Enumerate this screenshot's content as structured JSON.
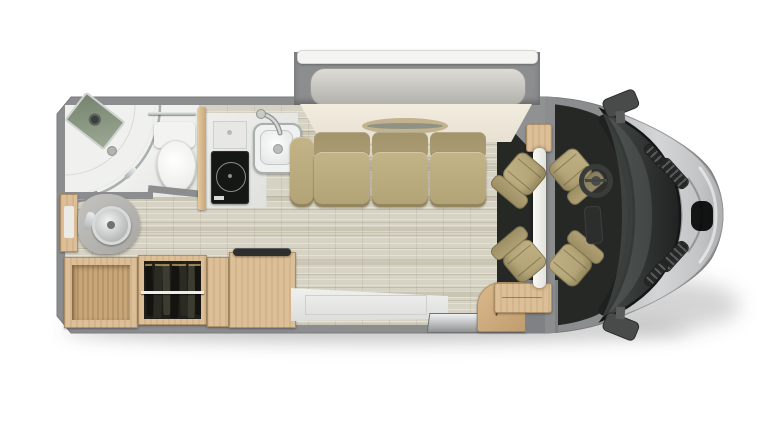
{
  "meta": {
    "view": "top-down RV motorhome floor plan rendering",
    "visible_text": "none"
  },
  "colors": {
    "background": "#ffffff",
    "body_wall_gray": "#8c8d8e",
    "floor_vinyl": "#d7d3c4",
    "bathroom_floor": "#f0f0ee",
    "sofa_tan": "#b9aa7c",
    "cab_seat_tan": "#b3a376",
    "wood_cabinet": "#dcbf96",
    "wood_interior": "#c8a678",
    "cab_floor_dark": "#272927",
    "hood_silver": "#c7c9cb",
    "windshield_dark": "#2e3231",
    "cooktop_black": "#151715",
    "hanging_clothes": "#1f1f1b",
    "chrome_fixture": "#c6cac9",
    "murphy_bed_roll": "#d2d0cb",
    "platform_ivory": "#efe9dc",
    "awning_white": "#f4f4f3"
  },
  "labels": {
    "vehicle": "motorhome floor plan",
    "slide_out": "slide-out room with awning",
    "murphy_bed": "rolled murphy bed",
    "platform": "bed platform with oval inlay",
    "sofa": "three-seat sofa",
    "shower": "corner shower with curved glass door",
    "shower_shelf": "shower shelf with shower head",
    "toilet": "toilet",
    "towel_bar": "towel bar",
    "vanity": "bathroom vanity with round sink",
    "bath_cabinet": "bathroom wall cabinet",
    "counter": "kitchen counter",
    "counter_flap": "flip-up counter extension",
    "cooktop": "induction cooktop",
    "kitchen_sink": "kitchen sink with faucet",
    "corner_cabinet": "open storage cabinet",
    "wardrobe": "wardrobe with hanging clothes",
    "clothes_rod": "closet rod",
    "refrigerator": "refrigerator cabinet with handle",
    "cabinet_divider": "cabinet divider",
    "entry_panel": "entry door panel",
    "entry_step": "entry step plate",
    "curved_cabinet": "curved entry cabinet",
    "step_well": "entry step well",
    "pillar": "slide-out pillar wall",
    "table": "stowed pedestal table",
    "cab_seat": "swivel captain chair",
    "steering_wheel": "steering wheel",
    "console": "center console",
    "dashboard": "dashboard",
    "windshield": "windshield",
    "hood": "hood",
    "mirror": "side mirror",
    "vent": "cowl vent",
    "nose": "front grille cowl",
    "drain": "shower drain",
    "wood_trim_front": "front lounge wood trim"
  }
}
